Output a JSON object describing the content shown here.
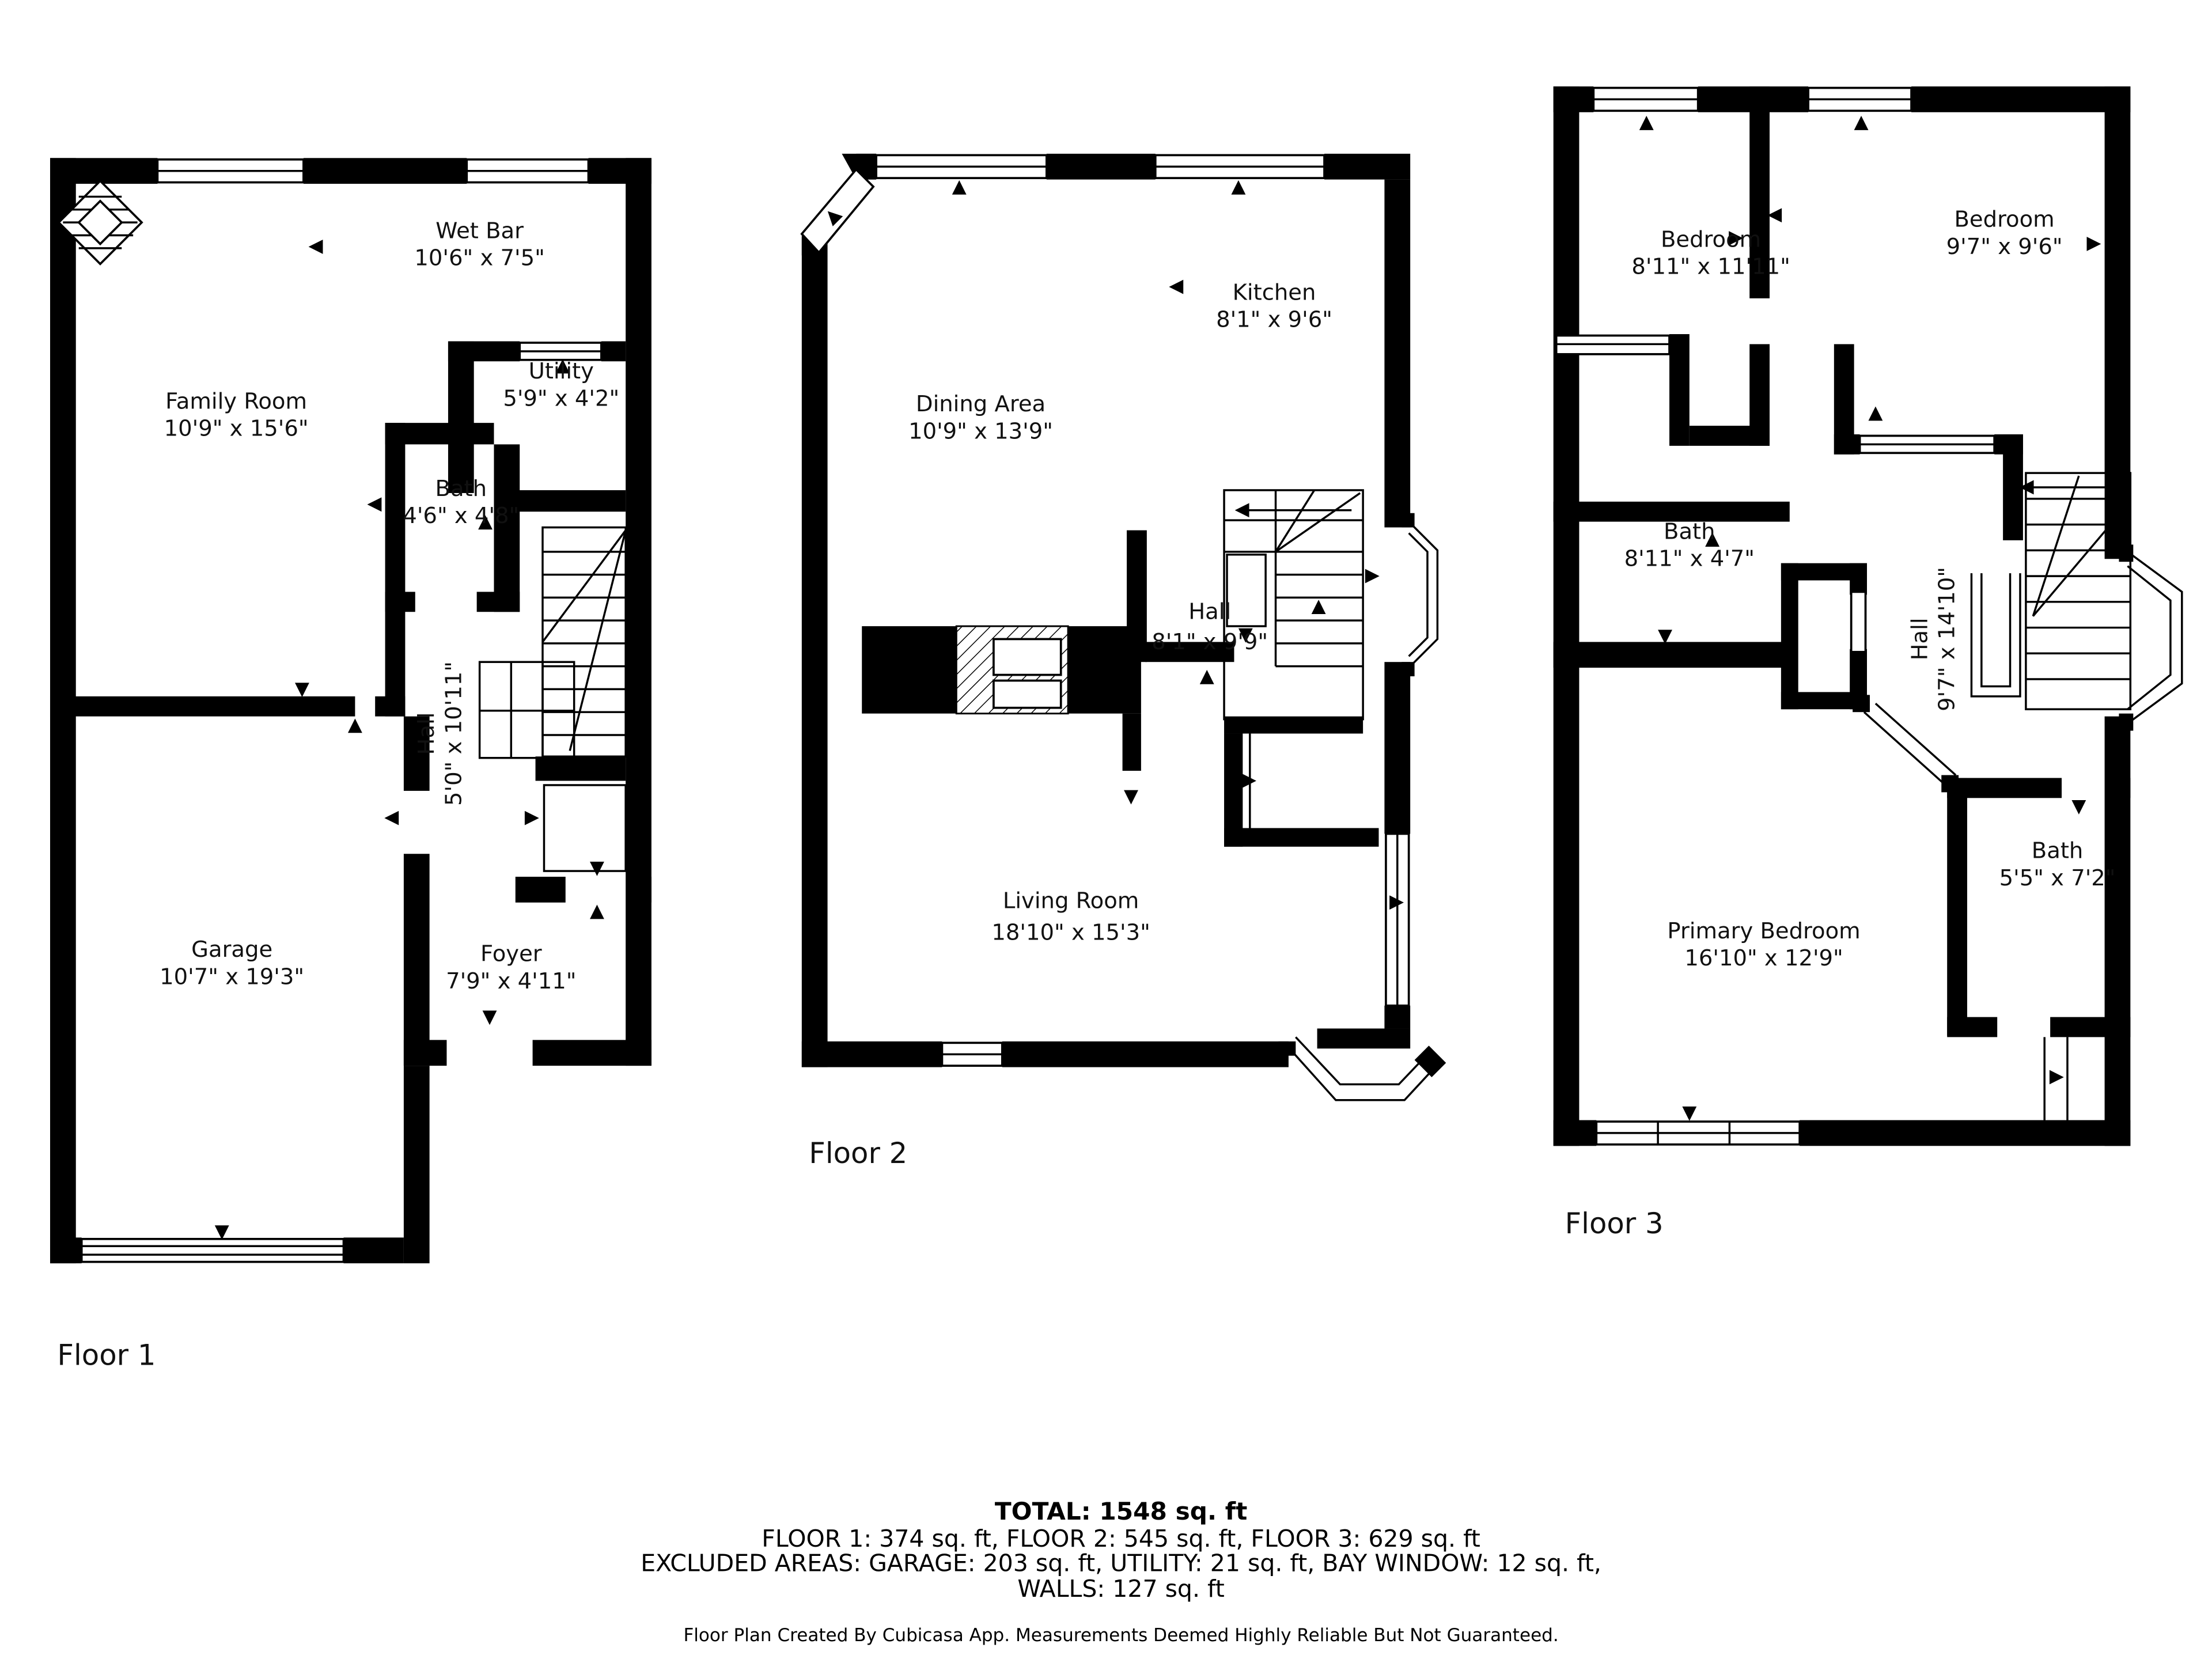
{
  "document_title": "Floor Plan",
  "floors": [
    {
      "label": "Floor 1",
      "rooms": [
        {
          "name": "Wet Bar",
          "dims": "10'6\" x 7'5\""
        },
        {
          "name": "Family Room",
          "dims": "10'9\" x 15'6\""
        },
        {
          "name": "Utility",
          "dims": "5'9\" x 4'2\""
        },
        {
          "name": "Bath",
          "dims": "4'6\" x 4'8\""
        },
        {
          "name": "Hall",
          "dims": "5'0\" x 10'11\""
        },
        {
          "name": "Garage",
          "dims": "10'7\" x 19'3\""
        },
        {
          "name": "Foyer",
          "dims": "7'9\" x 4'11\""
        }
      ]
    },
    {
      "label": "Floor 2",
      "rooms": [
        {
          "name": "Kitchen",
          "dims": "8'1\" x 9'6\""
        },
        {
          "name": "Dining Area",
          "dims": "10'9\" x 13'9\""
        },
        {
          "name": "Hall",
          "dims": "8'1\" x 9'9\""
        },
        {
          "name": "Living Room",
          "dims": "18'10\" x 15'3\""
        }
      ]
    },
    {
      "label": "Floor 3",
      "rooms": [
        {
          "name": "Bedroom",
          "dims": "8'11\" x 11'11\""
        },
        {
          "name": "Bedroom",
          "dims": "9'7\" x 9'6\""
        },
        {
          "name": "Bath",
          "dims": "8'11\" x 4'7\""
        },
        {
          "name": "Hall",
          "dims": "9'7\" x 14'10\""
        },
        {
          "name": "Primary Bedroom",
          "dims": "16'10\" x 12'9\""
        },
        {
          "name": "Bath",
          "dims": "5'5\" x 7'2\""
        }
      ]
    }
  ],
  "summary": {
    "total": "TOTAL: 1548 sq. ft",
    "floors_line": "FLOOR 1: 374 sq. ft, FLOOR 2: 545 sq. ft, FLOOR 3: 629 sq. ft",
    "excluded_line": "EXCLUDED AREAS: GARAGE: 203 sq. ft, UTILITY: 21 sq. ft, BAY WINDOW: 12 sq. ft,",
    "walls_line": "WALLS: 127 sq. ft"
  },
  "footer": "Floor Plan Created By Cubicasa App. Measurements Deemed Highly Reliable But Not Guaranteed.",
  "colors": {
    "wall": "#000000",
    "text": "#111111",
    "background": "#ffffff"
  }
}
